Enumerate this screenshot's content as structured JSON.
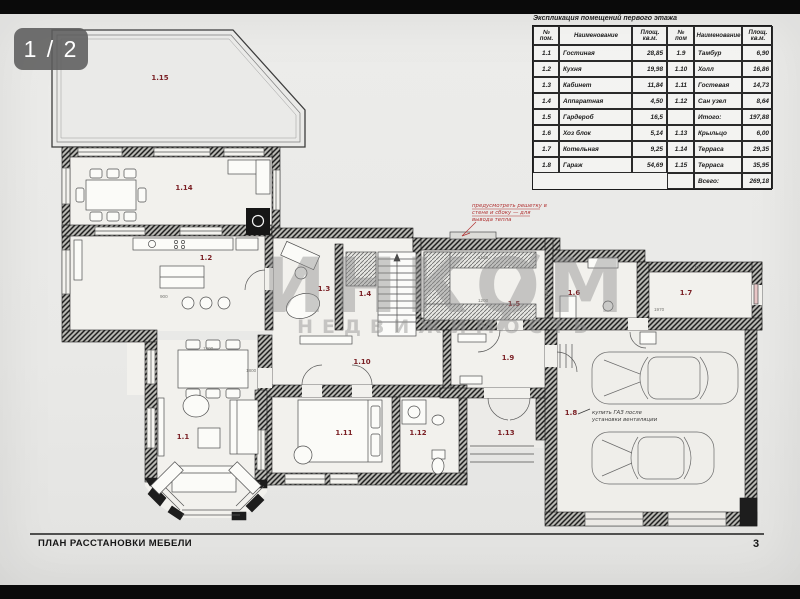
{
  "viewer": {
    "page_indicator": "1 / 2"
  },
  "sheet": {
    "title": "ПЛАН РАССТАНОВКИ МЕБЕЛИ",
    "page_number": "3",
    "watermark_line1": "ИНКОМ",
    "watermark_line2": "НЕДВИЖИМОСТЬ"
  },
  "table": {
    "caption": "Экспликация помещений первого этажа",
    "headers": [
      "№ пом.",
      "Наименование",
      "Площ. кв.м.",
      "№ пом",
      "Наименование",
      "Площ. кв.м."
    ],
    "rows": [
      [
        "1.1",
        "Гостиная",
        "28,85",
        "1.9",
        "Тамбур",
        "6,90"
      ],
      [
        "1.2",
        "Кухня",
        "19,98",
        "1.10",
        "Холл",
        "16,86"
      ],
      [
        "1.3",
        "Кабинет",
        "11,84",
        "1.11",
        "Гостевая",
        "14,73"
      ],
      [
        "1.4",
        "Аппаратная",
        "4,50",
        "1.12",
        "Сан узел",
        "8,64"
      ],
      [
        "1.5",
        "Гардероб",
        "16,5",
        "",
        "Итого:",
        "197,88"
      ],
      [
        "1.6",
        "Хоз блок",
        "5,14",
        "1.13",
        "Крыльцо",
        "6,00"
      ],
      [
        "1.7",
        "Котельная",
        "9,25",
        "1.14",
        "Терраса",
        "29,35"
      ],
      [
        "1.8",
        "Гараж",
        "54,69",
        "1.15",
        "Терраса",
        "35,95"
      ],
      [
        "",
        "",
        "",
        "",
        "Всего:",
        "269,18"
      ]
    ]
  },
  "plan": {
    "labels": {
      "r1_1": "1.1",
      "r1_2": "1.2",
      "r1_3": "1.3",
      "r1_4": "1.4",
      "r1_5": "1.5",
      "r1_6": "1.6",
      "r1_7": "1.7",
      "r1_8": "1.8",
      "r1_9": "1.9",
      "r1_10": "1.10",
      "r1_11": "1.11",
      "r1_12": "1.12",
      "r1_13": "1.13",
      "r1_14": "1.14",
      "r1_15": "1.15"
    },
    "notes": {
      "heat_line1": "предусмотреть решетку в",
      "heat_line2": "стене и сбоку — для",
      "heat_line3": "вывода тепла",
      "garage_line1": "купить ГАЗ после",
      "garage_line2": "установки вентиляции"
    },
    "dims": [
      "1400",
      "1800",
      "900",
      "1100",
      "1850",
      "1970",
      "1200",
      "700"
    ]
  },
  "colors": {
    "room_label": "#7a1f24",
    "note_red": "#b03030",
    "watermark": "#8f8f8f"
  }
}
